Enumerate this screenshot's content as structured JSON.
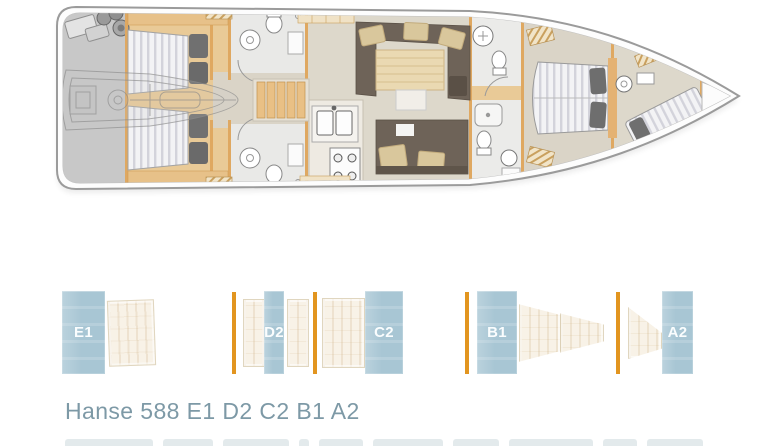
{
  "window": {
    "background": "#ffffff"
  },
  "floorplan": {
    "description": "Hanse 588 sailing yacht deck layout, top view, bow pointing right",
    "hull_fill": "#fdfdfd",
    "hull_stroke": "#9b9b9b",
    "wood_color": "#e9ca97",
    "floor_color": "#dcd6c9",
    "stern_garage_color": "#c8c8c8",
    "sofa_color": "#6e6358",
    "pillow_color": "#d9c79c",
    "mattress_stripe": "#d3d3db"
  },
  "selector": {
    "divider_color": "#e2951f",
    "highlight_color": "#a8c6d4",
    "selected": [
      {
        "label": "E1"
      },
      {
        "label": "D2"
      },
      {
        "label": "C2"
      },
      {
        "label": "B1"
      },
      {
        "label": "A2"
      }
    ]
  },
  "title": {
    "text": "Hanse 588 E1 D2 C2 B1 A2",
    "color": "#7d99a6"
  }
}
